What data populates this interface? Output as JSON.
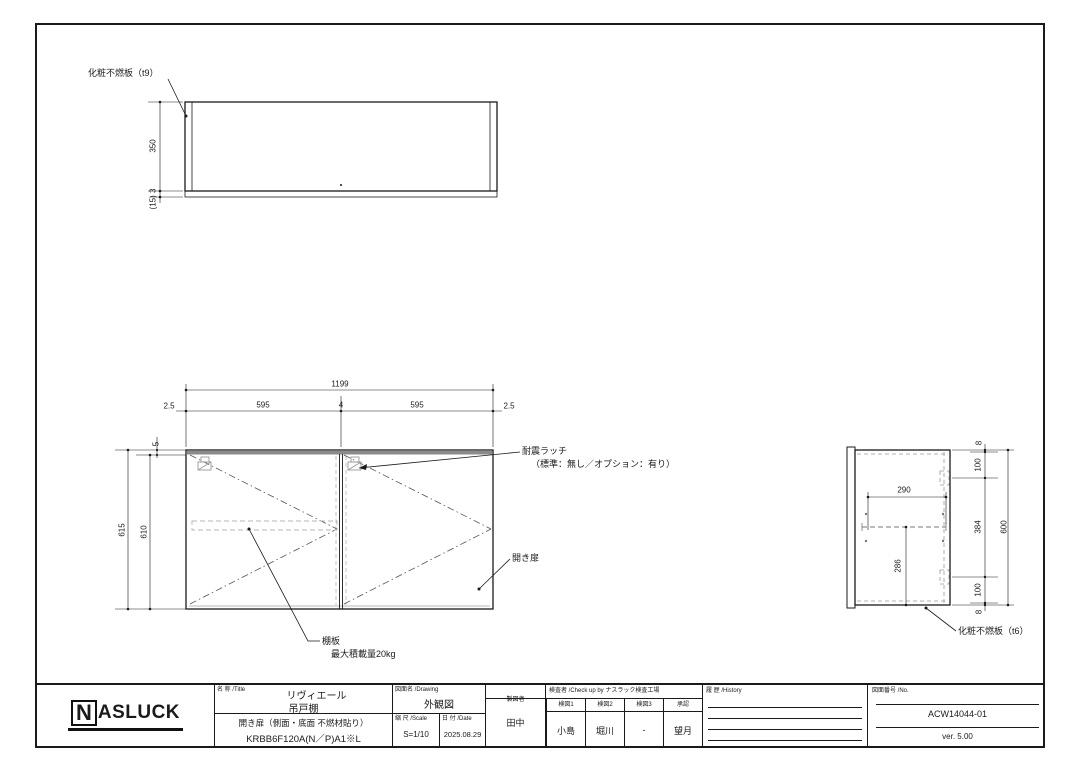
{
  "top_view": {
    "panel_label": "化粧不燃板（t9）",
    "dims": {
      "height": "350",
      "bottom": "(15) 3"
    }
  },
  "front_view": {
    "dims": {
      "total_width": "1199",
      "gap_left": "2.5",
      "door_left": "595",
      "center_gap": "4",
      "door_right": "595",
      "gap_right": "2.5",
      "top_panel": "5",
      "height_outer": "615",
      "height_inner": "610"
    },
    "labels": {
      "latch": "耐震ラッチ",
      "latch_note": "（標準：無し／オプション：有り）",
      "door": "開き扉",
      "shelf": "棚板",
      "shelf_note": "最大積載量20kg"
    }
  },
  "side_view": {
    "dims": {
      "shelf_depth": "290",
      "shelf_from_bottom": "286",
      "door_height": "600",
      "seg_top": "8",
      "seg_upper": "100",
      "seg_mid": "384",
      "seg_lower": "100",
      "seg_bottom": "8"
    },
    "labels": {
      "panel": "化粧不燃板（t6）"
    }
  },
  "title_block": {
    "logo_n": "N",
    "logo_rest": "ASLUCK",
    "name_header": "名 称 /Title",
    "product_line1": "リヴィエール",
    "product_line2": "吊戸棚",
    "product_line3": "開き扉（側面・底面 不燃材貼り）",
    "product_code": "KRBB6F120A(N／P)A1※L",
    "drawing_header": "図面名 /Drawing",
    "drawing_name": "外観図",
    "scale_header": "縮 尺 /Scale",
    "scale_value": "S=1/10",
    "date_header": "日 付 /Date",
    "date_value": "2025.08.29",
    "drafter_header": "製図者",
    "drafter": "田中",
    "check_header": "検査者 /Check up by ナスラック検査工場",
    "check_cols": [
      {
        "label": "検図1",
        "value": "小島"
      },
      {
        "label": "検図2",
        "value": "堀川"
      },
      {
        "label": "検図3",
        "value": "-"
      },
      {
        "label": "承認",
        "value": "望月"
      }
    ],
    "history_header": "履 歴 /History",
    "number_header": "図面番号 /No.",
    "drawing_number": "ACW14044-01",
    "version": "ver. 5.00"
  }
}
